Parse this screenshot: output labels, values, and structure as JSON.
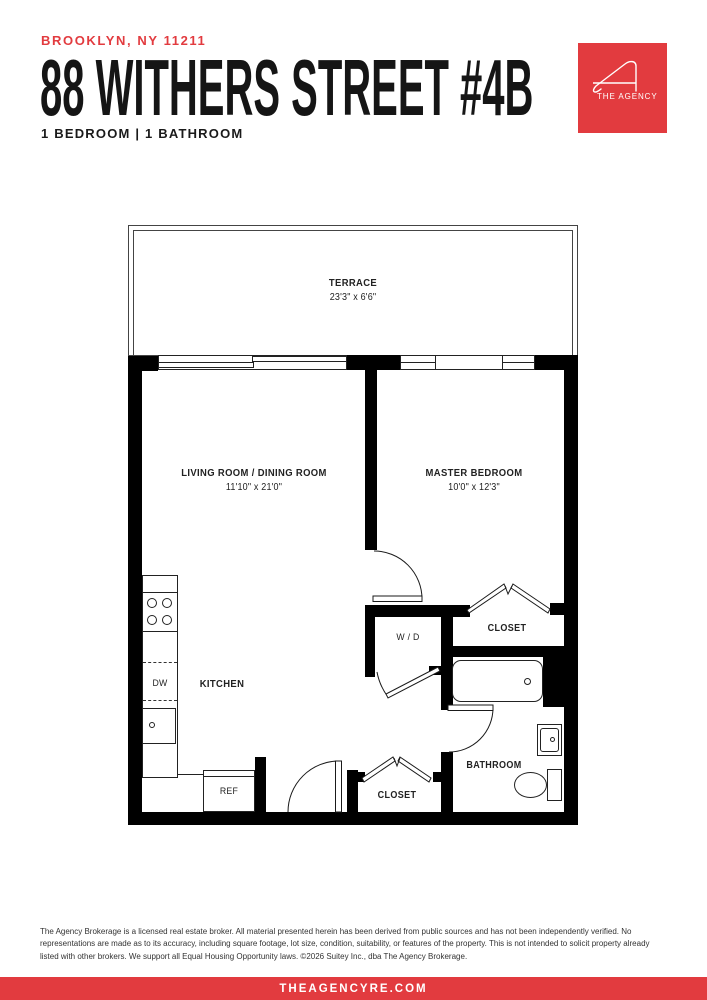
{
  "header": {
    "location": "BROOKLYN, NY 11211",
    "title": "88 WITHERS STREET #4B",
    "subtitle": "1 BEDROOM | 1 BATHROOM",
    "logo": {
      "brand": "THE AGENCY",
      "icon": "agency-a-logo"
    }
  },
  "floorplan": {
    "rooms": [
      {
        "id": "terrace",
        "name": "TERRACE",
        "dims": "23'3\" x 6'6\""
      },
      {
        "id": "living-dining",
        "name": "LIVING ROOM / DINING ROOM",
        "dims": "11'10\" x 21'0\""
      },
      {
        "id": "master-bedroom",
        "name": "MASTER BEDROOM",
        "dims": "10'0\" x 12'3\""
      },
      {
        "id": "kitchen",
        "name": "KITCHEN"
      },
      {
        "id": "bathroom",
        "name": "BATHROOM"
      },
      {
        "id": "closet-bedroom",
        "name": "CLOSET"
      },
      {
        "id": "closet-entry",
        "name": "CLOSET"
      }
    ],
    "fixtures": {
      "washer_dryer": "W / D",
      "dishwasher": "DW",
      "refrigerator": "REF"
    }
  },
  "footer": {
    "disclaimer": "The Agency Brokerage is a licensed real estate broker. All material presented herein has been derived from public sources and has not been independently verified. No representations are made as to its accuracy, including square footage, lot size, condition, suitability, or features of the property. This is not intended to solicit property already listed with other brokers. We support all Equal Housing Opportunity laws. ©2026 Suitey Inc., dba The Agency Brokerage.",
    "website": "THEAGENCYRE.COM"
  },
  "colors": {
    "accent": "#E23B3F",
    "wall": "#000000"
  }
}
